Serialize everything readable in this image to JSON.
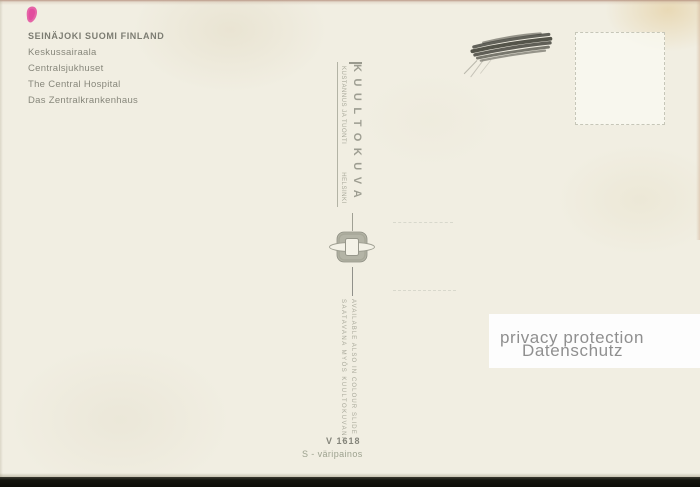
{
  "caption": {
    "title": "SEINÄJOKI SUOMI FINLAND",
    "lines": [
      "Keskussairaala",
      "Centralsjukhuset",
      "The Central Hospital",
      "Das Zentralkrankenhaus"
    ]
  },
  "publisher": {
    "brand": "KUULTOKUVA",
    "imprint": "KUSTANNUS JA TUONTI",
    "city": "HELSINKI"
  },
  "availability": {
    "finnish": "SAATAVANA MYÖS KUULTOKUVANA",
    "english": "AVAILABLE ALSO IN COLOUR SLIDE"
  },
  "catalog": {
    "number": "V 1618",
    "print_note": "S - väripainos"
  },
  "privacy_overlay": {
    "line1": "privacy protection",
    "line2": "Datenschutz"
  },
  "icons": {
    "pink_mark": "pink-mark",
    "scribble": "pencil-scribble",
    "emblem": "slide-viewer-emblem",
    "stamp_box": "stamp-box"
  },
  "colors": {
    "card": "#f1eee2",
    "ink": "#84847a",
    "faded_ink": "#a9a99b",
    "accent_pink": "#e459a2",
    "privacy_text": "#8f8f8f",
    "bottom_bar": "#16160f"
  }
}
